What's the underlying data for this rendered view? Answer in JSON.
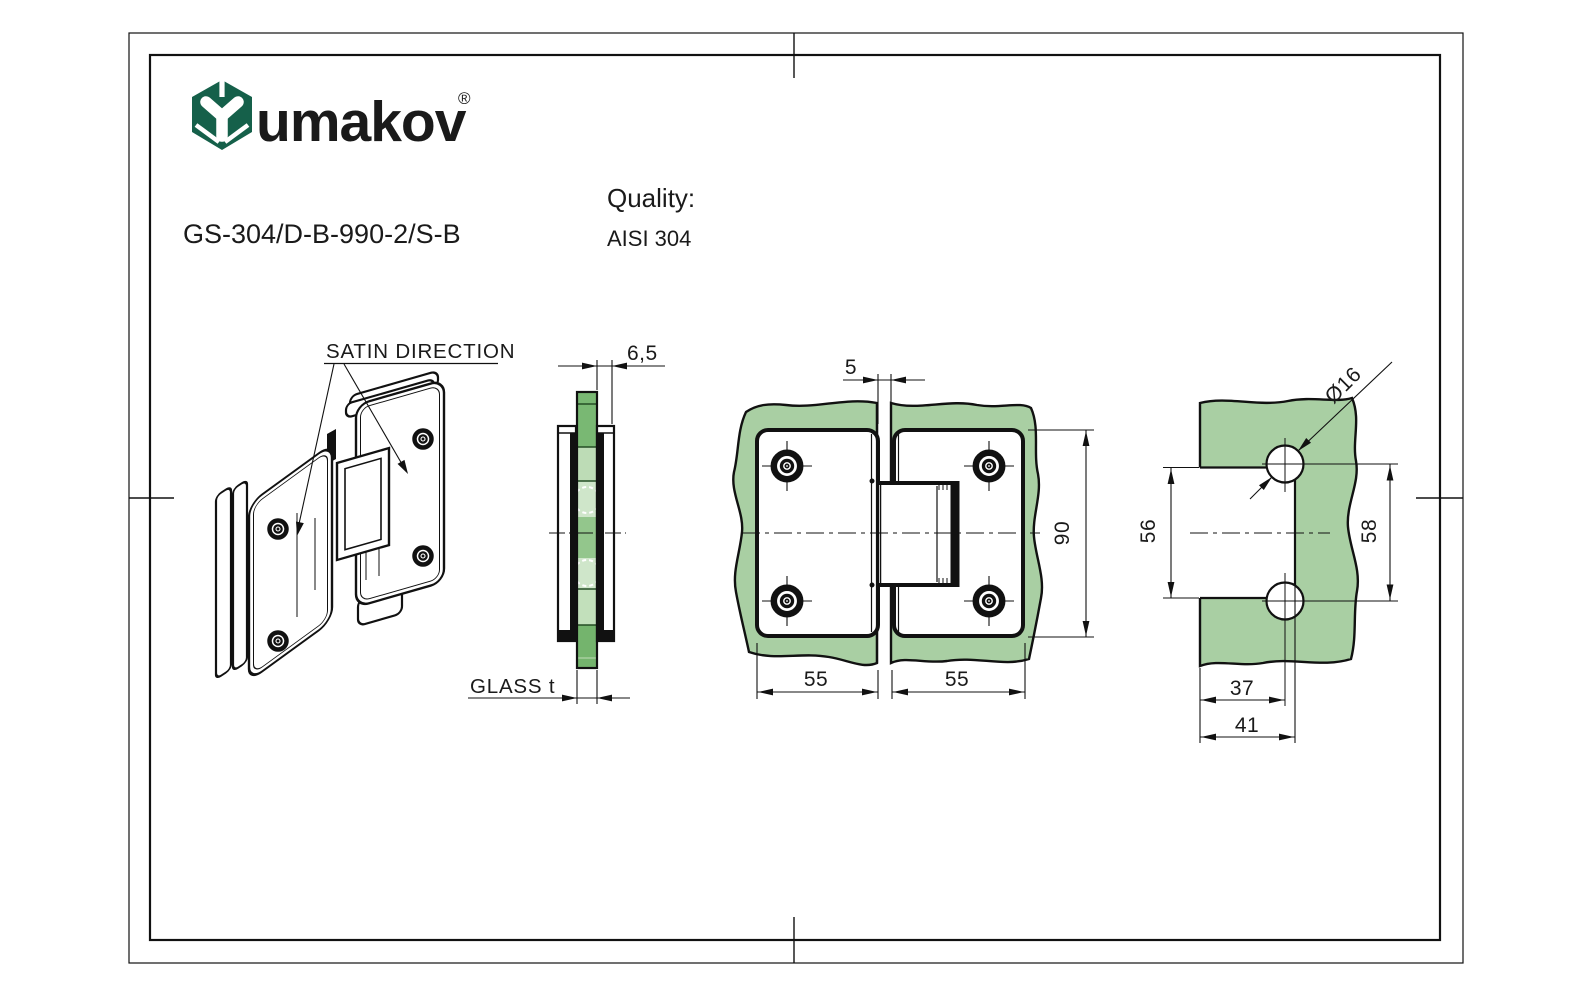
{
  "header": {
    "logo": {
      "wordmark": "umakov",
      "registered": "®",
      "color": "#15604a"
    },
    "product_code": "GS-304/D-B-990-2/S-B",
    "quality_label": "Quality:",
    "quality_value": "AISI 304"
  },
  "drawing": {
    "colors": {
      "glass": "#a9cfa3",
      "glass_edge_medium": "#79b873",
      "glass_edge_light": "#c2e0bb",
      "glass_edge_pale": "#cfe6ca",
      "line": "#111111"
    },
    "labels": {
      "satin_direction": "SATIN DIRECTION",
      "glass_thickness": "GLASS t"
    },
    "dimensions": {
      "gap": "5",
      "plate_offset": "6,5",
      "hinge_height": "90",
      "left_plate_width": "55",
      "right_plate_width": "55",
      "hole_diameter": "Ø16",
      "cutout_height": "56",
      "hole_centers": "58",
      "hole_center_offset": "37",
      "cutout_width": "41"
    }
  }
}
